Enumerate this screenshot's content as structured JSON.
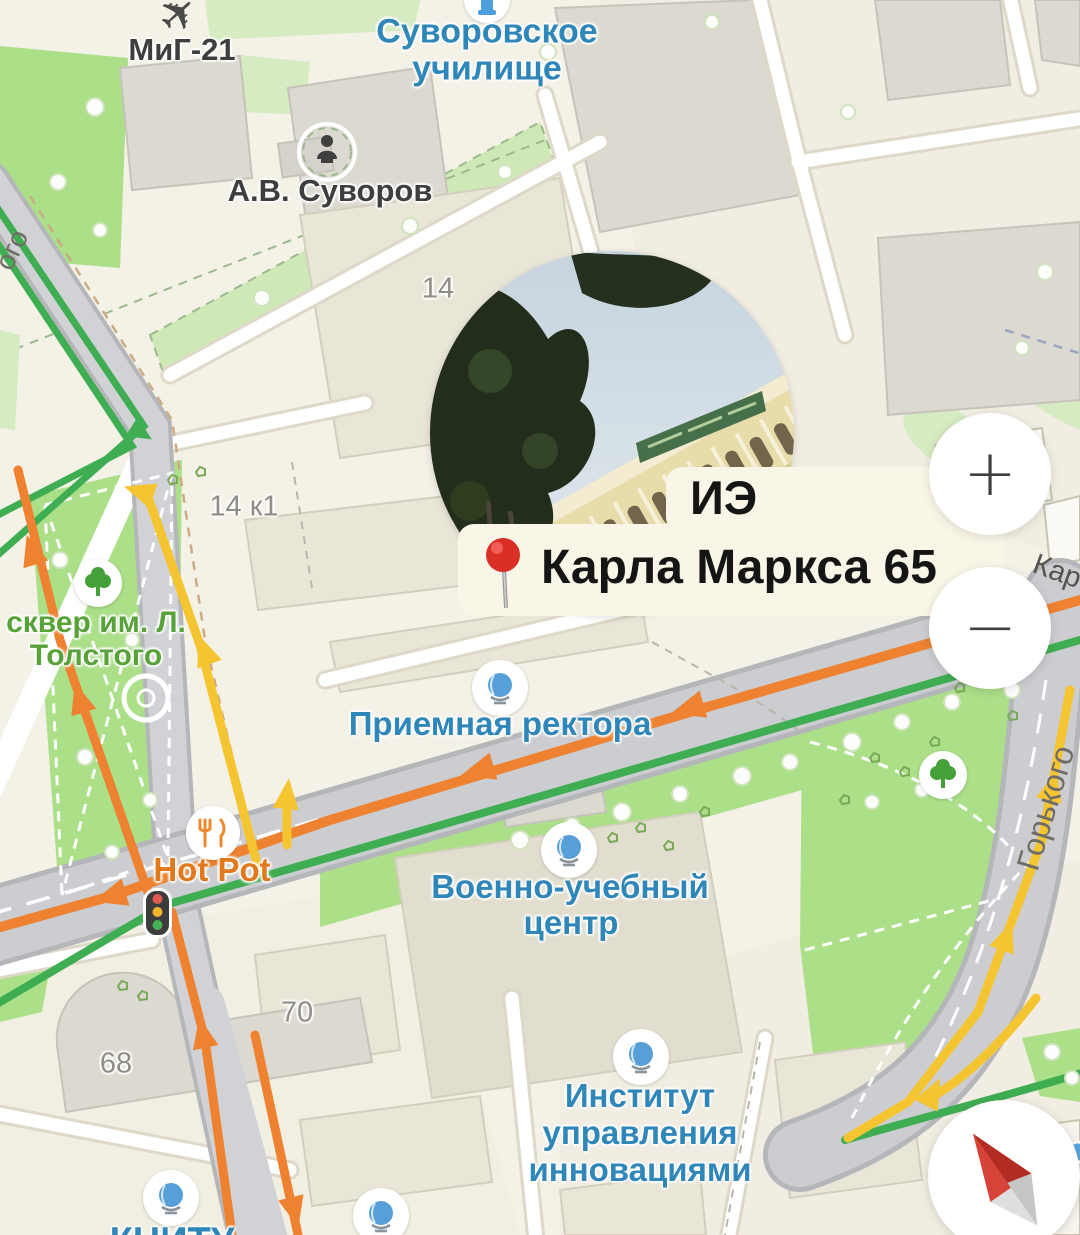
{
  "app": {
    "type": "map-view"
  },
  "place": {
    "name": "ИЭ",
    "address": "Карла Маркса 65"
  },
  "controls": {
    "zoom_in": "+",
    "zoom_out": "−"
  },
  "labels": {
    "mig21": "МиГ-21",
    "suvorov_school_1": "Суворовское",
    "suvorov_school_2": "училище",
    "suvorov_monument": "А.В. Суворов",
    "bldg_14": "14",
    "bldg_14k1": "14 к1",
    "park_tolstoy_1": "сквер им. Л.",
    "park_tolstoy_2": "Толстого",
    "rector": "Приемная ректора",
    "hotpot": "Hot Pot",
    "military_1": "Военно-учебный",
    "military_2": "центр",
    "bldg_70": "70",
    "bldg_68": "68",
    "institute_1": "Институт",
    "institute_2": "управления",
    "institute_3": "инновациями",
    "knitu": "КНИТУ",
    "street_gorky": "Горького",
    "street_karl": "Кар",
    "street_partial": "ого"
  },
  "icons": {
    "airplane": "airplane-icon",
    "monument": "monument-icon",
    "school": "school-icon",
    "tree": "tree-icon",
    "globe": "education-globe-icon",
    "restaurant": "restaurant-icon",
    "traffic_light": "traffic-light-icon",
    "pin": "red-pin-icon",
    "compass": "compass-needle-icon"
  },
  "colors": {
    "land": "#f4f1e7",
    "park-bright": "#abdf88",
    "park-light": "#d6ebc2",
    "building": "#e9e5d7",
    "road-gray": "#cbcdd1",
    "traffic-orange": "#ee8231",
    "traffic-yellow": "#f5c531",
    "traffic-green": "#3fae52",
    "poi-blue": "#2f86b8",
    "poi-green": "#58a23a",
    "poi-orange": "#e2791d",
    "label-bg": "#f9f5e7",
    "label-text": "#151515",
    "pin-red": "#e0352b"
  }
}
